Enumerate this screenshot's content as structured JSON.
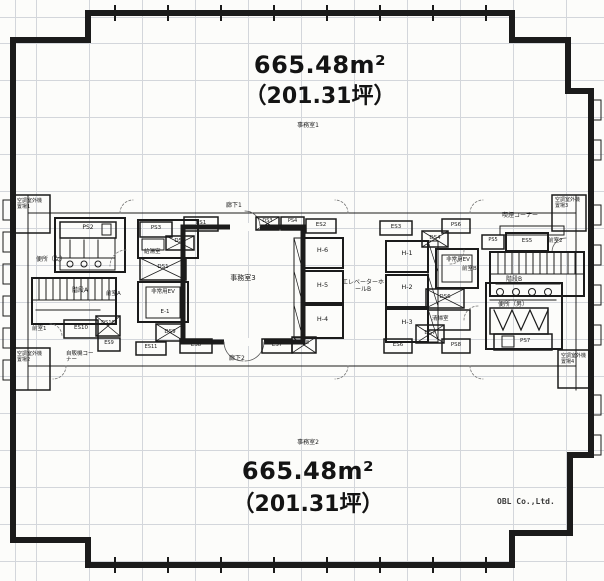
{
  "colors": {
    "paper": "#fcfcfa",
    "line": "#1b1b1b",
    "grid": "#d3d6db",
    "dim_text": "#3a3a3a"
  },
  "areas": {
    "office1": {
      "label": "事務室1",
      "sqm": "665.48m²",
      "tsubo": "（201.31坪）"
    },
    "office2": {
      "label": "事務室2",
      "sqm": "665.48m²",
      "tsubo": "（201.31坪）"
    },
    "office3": {
      "label": "事務室3"
    }
  },
  "corridors": {
    "corridor1": "廊下1",
    "corridor2": "廊下2"
  },
  "core": {
    "wc_women": "便所（女）",
    "wc_men": "便所（男）",
    "stairs_a": "階段A",
    "stairs_b": "階段B",
    "ante_a": "前室A",
    "ante_b": "前室B",
    "ante_1": "前室1",
    "ante_2": "前室2",
    "kitchenette": "給湯室",
    "cleaning_room": "清掃室",
    "vending_corner": "自販機コーナー",
    "smoking_corner": "喫煙コーナー",
    "ev_hall": "エレベーターホールB",
    "emergency_ev": "非常用EV",
    "emergency_ev_no": "E-1",
    "ac_yard_1": "空調室外機置場1",
    "ac_yard_2": "空調室外機置場2",
    "ac_yard_3": "空調室外機置場3",
    "ac_yard_4": "空調室外機置場4"
  },
  "elevators": {
    "h1": "H-1",
    "h2": "H-2",
    "h3": "H-3",
    "h4": "H-4",
    "h5": "H-5",
    "h6": "H-6"
  },
  "shafts": {
    "ps2": "PS2",
    "ps3": "PS3",
    "ps4": "PS4",
    "ps5": "PS5",
    "ps6": "PS6",
    "ps7": "PS7",
    "ps8": "PS8",
    "ds1": "DS1",
    "ds2": "DS2",
    "ds3": "DS3",
    "ds4": "DS4",
    "ds6": "DS6",
    "ds7": "DS7",
    "ds8": "DS8",
    "ds9": "DS9",
    "ds10": "DS10",
    "es1": "ES1",
    "es2": "ES2",
    "es3": "ES3",
    "es5": "ES5",
    "es6": "ES6",
    "es7": "ES7",
    "es8": "ES8",
    "es9": "ES9",
    "es10": "ES10",
    "es11": "ES11"
  },
  "watermark": "OBL Co.,Ltd."
}
